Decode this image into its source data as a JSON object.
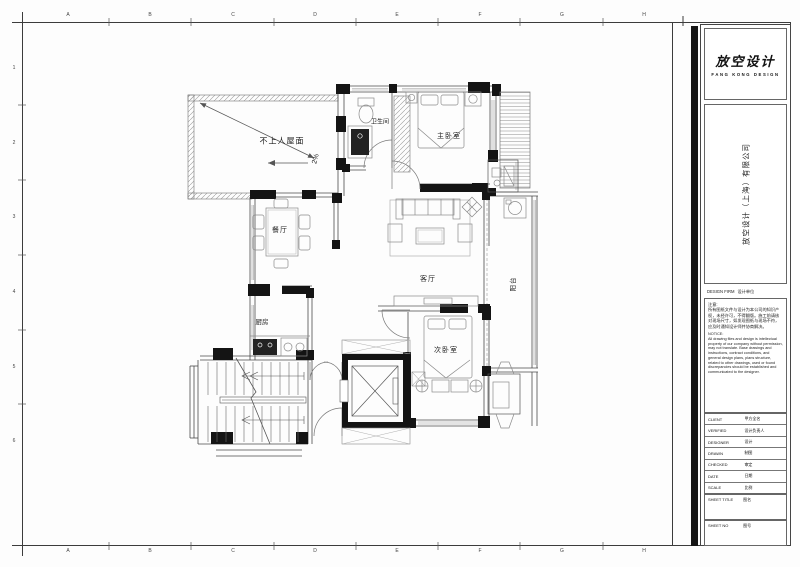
{
  "grid": {
    "top": [
      "A",
      "B",
      "C",
      "D",
      "E",
      "F",
      "G",
      "H"
    ],
    "bottom": [
      "A",
      "B",
      "C",
      "D",
      "E",
      "F",
      "G",
      "H"
    ],
    "left": [
      "1",
      "2",
      "3",
      "4",
      "5",
      "6"
    ]
  },
  "plan": {
    "labels": {
      "roof": "不上人屋面",
      "slope": "2%",
      "bath": "卫生间",
      "master": "主卧室",
      "dining": "餐厅",
      "living": "客厅",
      "balcony": "阳台",
      "kitchen": "厨房",
      "second": "次卧室"
    }
  },
  "titleblock": {
    "logo_title": "放空设计",
    "logo_subtitle": "FANG KONG DESIGN",
    "company": "放空设计（上海）有限公司",
    "firm_en": "DESIGN FIRM",
    "firm_zh": "设计单位",
    "notes_zh_title": "注意:",
    "notes_zh": "所有图纸文件与设计为本公司的知识产权，未经许可，不得翻版。施工前请核对现场尺寸，如发现图纸与现场不符，应及时通知设计师并协商解决。",
    "notes_en_title": "NOTICE:",
    "notes_en": "All drawing files and design is intellectual property of our company without permission, may not translate. Base drawings and instructions, contract conditions, and general design plans, plans structure, related to other drawings, used or found discrepancies should be established and communicated to the designer.",
    "rows": [
      {
        "en": "CLIENT",
        "zh": "甲方全名"
      },
      {
        "en": "VERIFIED",
        "zh": "设计负责人"
      },
      {
        "en": "DESIGNER",
        "zh": "设计"
      },
      {
        "en": "DRAWN",
        "zh": "制图"
      },
      {
        "en": "CHECKED",
        "zh": "审定"
      },
      {
        "en": "DATE",
        "zh": "日期"
      },
      {
        "en": "SCALE",
        "zh": "比例"
      },
      {
        "en": "SHEET TITLE",
        "zh": "图名"
      },
      {
        "en": "SHEET NO",
        "zh": "图号"
      }
    ]
  }
}
